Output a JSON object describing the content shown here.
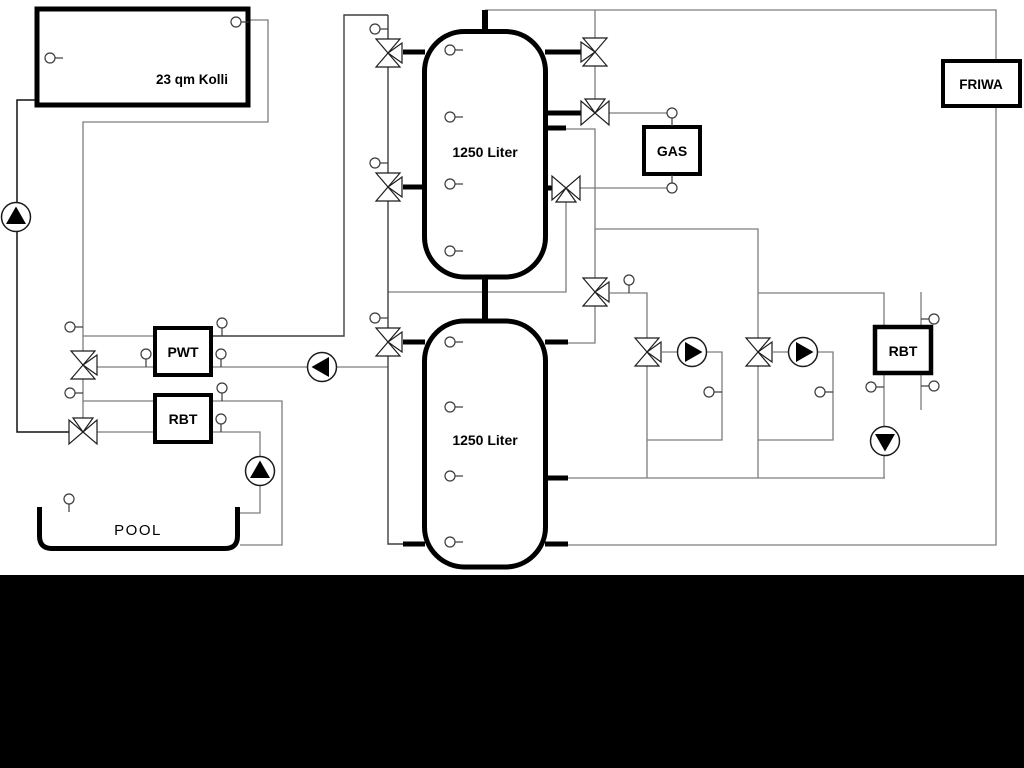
{
  "diagram": {
    "collector": {
      "label": "23 qm Kolli"
    },
    "tank1": {
      "label": "1250 Liter"
    },
    "tank2": {
      "label": "1250 Liter"
    },
    "pwt": {
      "label": "PWT"
    },
    "rbt_left": {
      "label": "RBT"
    },
    "rbt_right": {
      "label": "RBT"
    },
    "gas": {
      "label": "GAS"
    },
    "friwa": {
      "label": "FRIWA"
    },
    "pool": {
      "label": "POOL"
    },
    "colors": {
      "background": "#ffffff",
      "pipe": "#7d7d7d",
      "pipe_dark": "#111111",
      "pipe_mid": "#3f3f3f",
      "component": "#000000",
      "bottom_band": "#000000"
    }
  }
}
